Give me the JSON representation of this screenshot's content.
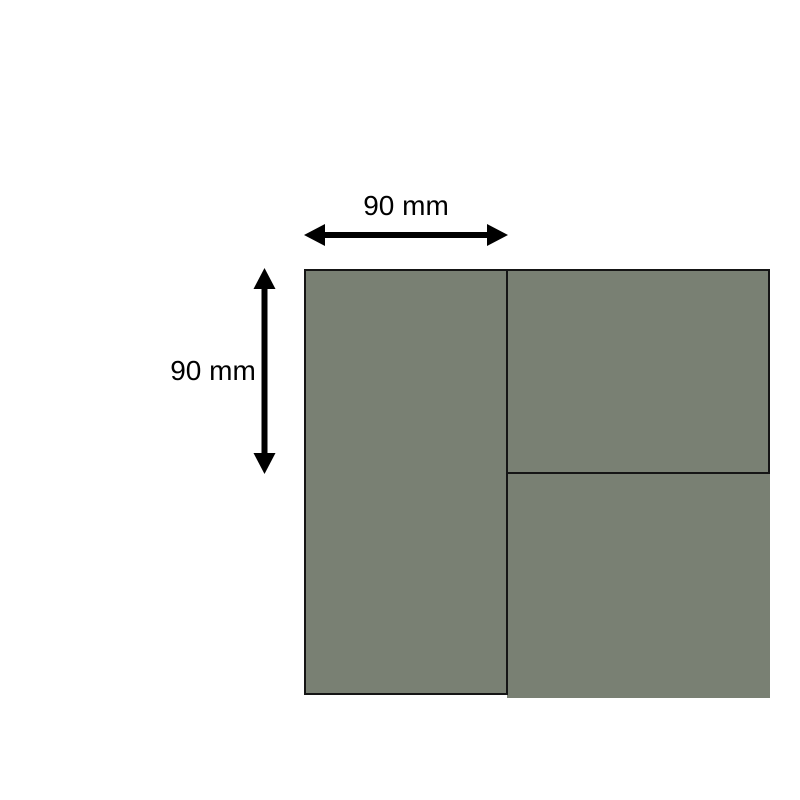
{
  "diagram": {
    "width_dimension": {
      "label": "90 mm"
    },
    "height_dimension": {
      "label": "90 mm"
    }
  },
  "colors": {
    "background": "#ffffff",
    "panel_fill": "#798073",
    "panel_border": "#151515",
    "arrow": "#000000",
    "text": "#000000"
  }
}
